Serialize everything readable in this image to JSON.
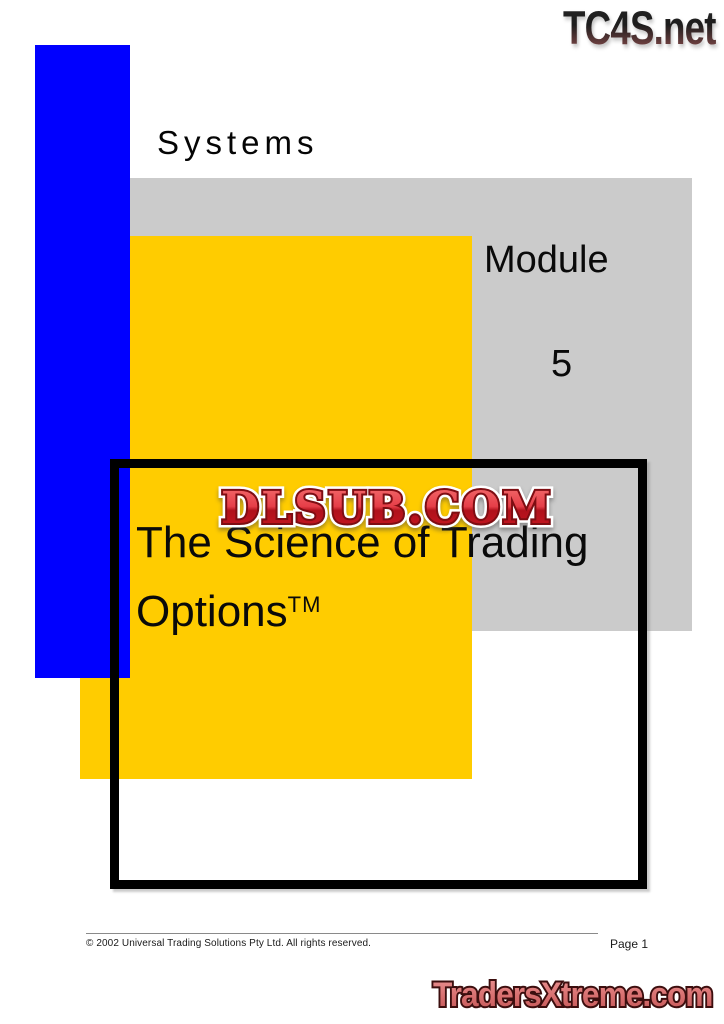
{
  "branding": {
    "header_logo": "TC4S.net",
    "watermark": "DLSUB.COM",
    "footer_logo": "TradersXtreme.com"
  },
  "cover": {
    "series_label": "Systems",
    "module_label": "Module",
    "module_number": "5",
    "title_line1": "The Science of Trading",
    "title_line2": "Options",
    "trademark": "TM"
  },
  "footer": {
    "copyright": "© 2002 Universal Trading Solutions Pty Ltd. All rights reserved.",
    "page_label": "Page 1"
  },
  "colors": {
    "blue": "#0000FF",
    "yellow": "#FFCC00",
    "gray": "#CBCBCB",
    "frame": "#000000",
    "watermark_red": "#C41E25",
    "logo_red": "#D06868"
  }
}
